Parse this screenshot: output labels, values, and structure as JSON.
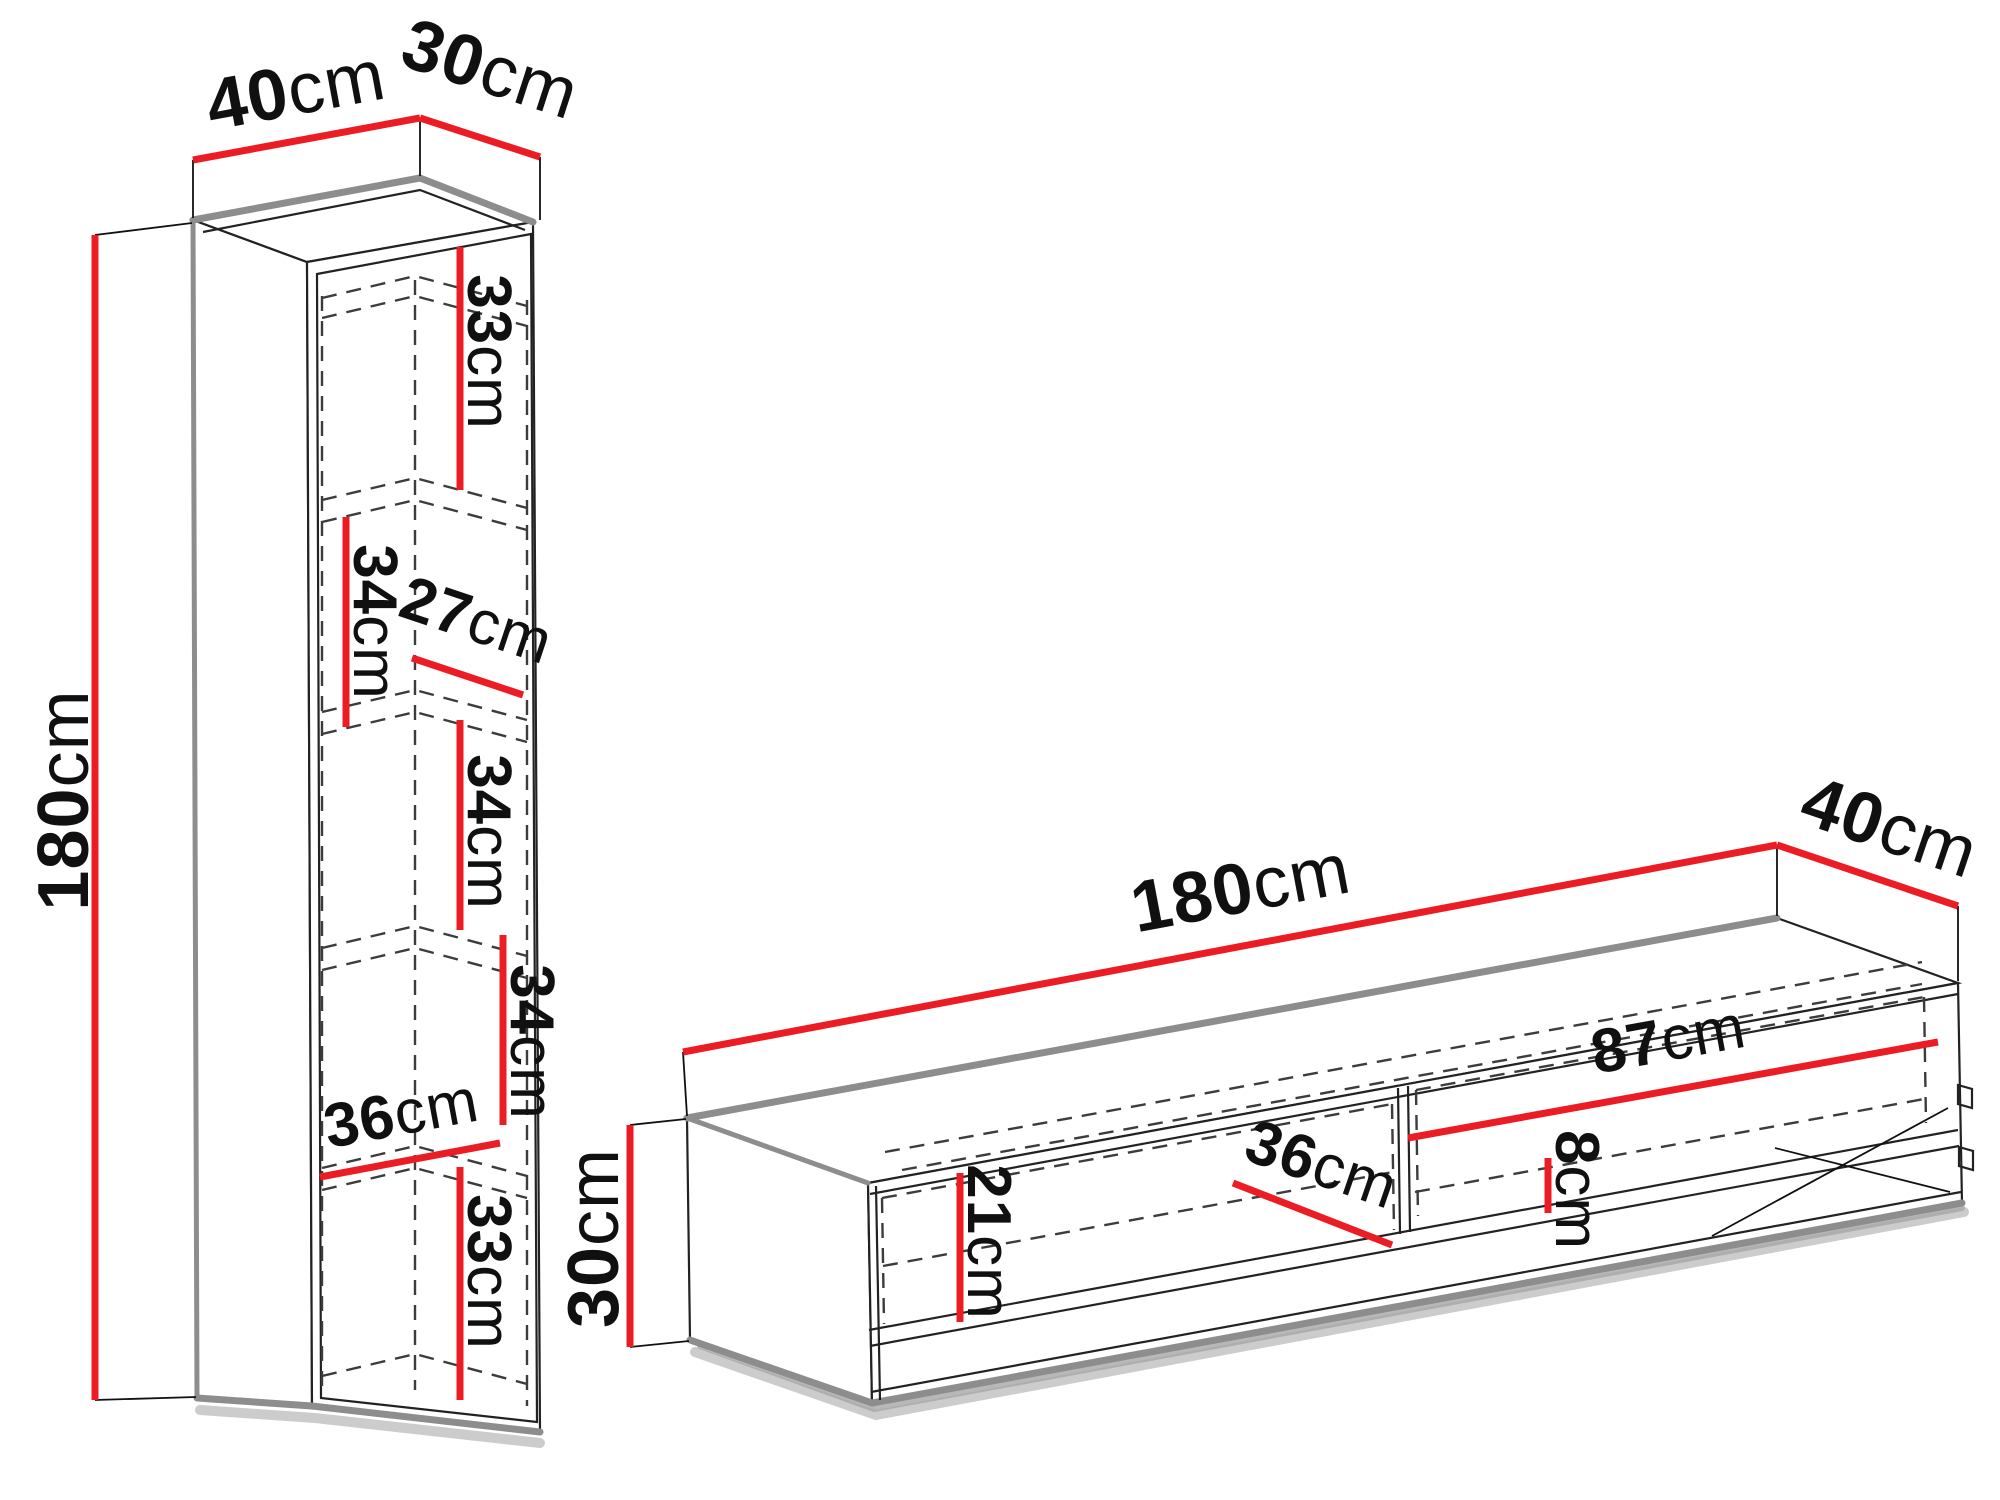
{
  "title": "Furniture set dimensions diagram",
  "unit": "cm",
  "colors": {
    "dimension_line": "#ec1c24",
    "outline": "#222222",
    "edge_shade": "#8d8d8d",
    "background": "#ffffff"
  },
  "cabinet": {
    "name": "tall wall cabinet",
    "overall": {
      "width": {
        "value": "40",
        "unit": "cm"
      },
      "depth": {
        "value": "30",
        "unit": "cm"
      },
      "height": {
        "value": "180",
        "unit": "cm"
      }
    },
    "internal": {
      "compartment_1_height": {
        "value": "33",
        "unit": "cm"
      },
      "compartment_2_height": {
        "value": "34",
        "unit": "cm"
      },
      "inner_depth": {
        "value": "27",
        "unit": "cm"
      },
      "compartment_3_height": {
        "value": "34",
        "unit": "cm"
      },
      "compartment_4_height": {
        "value": "34",
        "unit": "cm"
      },
      "inner_width": {
        "value": "36",
        "unit": "cm"
      },
      "compartment_5_height": {
        "value": "33",
        "unit": "cm"
      }
    }
  },
  "tv_stand": {
    "name": "TV stand",
    "overall": {
      "width": {
        "value": "180",
        "unit": "cm"
      },
      "depth": {
        "value": "40",
        "unit": "cm"
      },
      "height": {
        "value": "30",
        "unit": "cm"
      }
    },
    "internal": {
      "niche_width": {
        "value": "87",
        "unit": "cm"
      },
      "slot_height": {
        "value": "8",
        "unit": "cm"
      },
      "inner_depth": {
        "value": "36",
        "unit": "cm"
      },
      "niche_height": {
        "value": "21",
        "unit": "cm"
      }
    }
  }
}
